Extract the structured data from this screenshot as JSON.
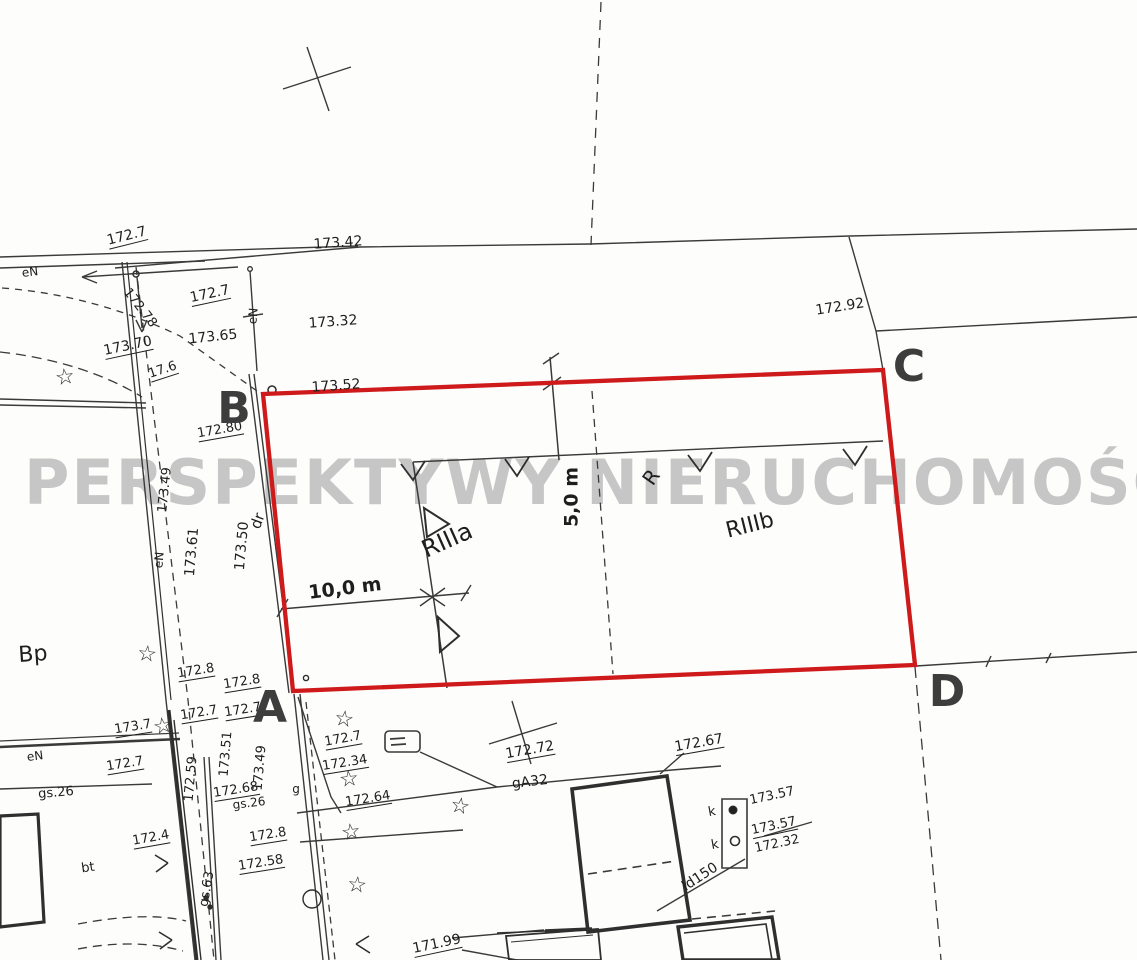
{
  "map": {
    "type": "cadastral-survey-map",
    "watermark": "PERSPEKTYWY NIERUCHOMOŚCI",
    "colors": {
      "plot_outline": "#ce1a1a",
      "line_ink": "#3a3a3a",
      "building_ink": "#2f2f2f",
      "watermark_gray": "#a6a6a6",
      "label_ink": "#1e1e1e"
    },
    "plot_corners": [
      {
        "id": "A",
        "x": 270,
        "y": 708
      },
      {
        "id": "B",
        "x": 234,
        "y": 409
      },
      {
        "id": "C",
        "x": 909,
        "y": 367
      },
      {
        "id": "D",
        "x": 947,
        "y": 692
      }
    ],
    "symbols": {
      "star_glyph": "☆"
    },
    "stars": [
      {
        "x": 65,
        "y": 378,
        "r": -8
      },
      {
        "x": 147,
        "y": 655,
        "r": 6
      },
      {
        "x": 163,
        "y": 727,
        "r": -10
      },
      {
        "x": 344,
        "y": 720,
        "r": 8
      },
      {
        "x": 349,
        "y": 780,
        "r": -6
      },
      {
        "x": 460,
        "y": 807,
        "r": 10
      },
      {
        "x": 351,
        "y": 833,
        "r": -8
      },
      {
        "x": 357,
        "y": 886,
        "r": 6
      }
    ],
    "labels": [
      {
        "t": "172.7",
        "x": 127,
        "y": 237,
        "r": -14,
        "s": 14,
        "u": 1,
        "n": "elevation-label"
      },
      {
        "t": "173.42",
        "x": 338,
        "y": 243,
        "r": -4,
        "s": 14,
        "n": "elevation-label"
      },
      {
        "t": "eN",
        "x": 30,
        "y": 272,
        "r": -6,
        "s": 12,
        "n": "utility-label"
      },
      {
        "t": "172.78",
        "x": 140,
        "y": 308,
        "r": 52,
        "s": 13,
        "n": "elevation-label"
      },
      {
        "t": "172.7",
        "x": 210,
        "y": 295,
        "r": -12,
        "s": 14,
        "u": 1,
        "n": "elevation-label"
      },
      {
        "t": "173.65",
        "x": 213,
        "y": 337,
        "r": -6,
        "s": 14,
        "n": "elevation-label"
      },
      {
        "t": "173.32",
        "x": 333,
        "y": 322,
        "r": -4,
        "s": 14,
        "n": "elevation-label"
      },
      {
        "t": "172.92",
        "x": 840,
        "y": 307,
        "r": -9,
        "s": 14,
        "n": "elevation-label"
      },
      {
        "t": "173.70",
        "x": 128,
        "y": 347,
        "r": -12,
        "s": 14,
        "u": 1,
        "n": "elevation-label"
      },
      {
        "t": "17.6",
        "x": 163,
        "y": 371,
        "r": -18,
        "s": 13,
        "u": 1,
        "n": "elevation-label"
      },
      {
        "t": "173.52",
        "x": 336,
        "y": 386,
        "r": -4,
        "s": 14,
        "n": "elevation-label"
      },
      {
        "t": "172.80",
        "x": 220,
        "y": 431,
        "r": -10,
        "s": 13,
        "u": 1,
        "n": "elevation-label"
      },
      {
        "t": "eN",
        "x": 253,
        "y": 316,
        "r": -85,
        "s": 12,
        "n": "utility-label"
      },
      {
        "t": "173.49",
        "x": 165,
        "y": 490,
        "r": -84,
        "s": 13,
        "n": "elevation-label"
      },
      {
        "t": "173.61",
        "x": 192,
        "y": 552,
        "r": -85,
        "s": 14,
        "n": "elevation-label"
      },
      {
        "t": "173.50",
        "x": 242,
        "y": 546,
        "r": -85,
        "s": 14,
        "n": "elevation-label"
      },
      {
        "t": "dr",
        "x": 258,
        "y": 521,
        "r": -70,
        "s": 15,
        "n": "landuse-label"
      },
      {
        "t": "eN",
        "x": 159,
        "y": 560,
        "r": -85,
        "s": 12,
        "n": "utility-label"
      },
      {
        "t": "Bp",
        "x": 33,
        "y": 655,
        "r": -4,
        "s": 22,
        "n": "landuse-label"
      },
      {
        "t": "RIIIa",
        "x": 447,
        "y": 540,
        "r": -24,
        "s": 24,
        "n": "landuse-label"
      },
      {
        "t": "RIIIb",
        "x": 750,
        "y": 526,
        "r": -14,
        "s": 22,
        "n": "landuse-label"
      },
      {
        "t": "R",
        "x": 651,
        "y": 477,
        "r": -55,
        "s": 20,
        "n": "landuse-label"
      },
      {
        "t": "10,0 m",
        "x": 345,
        "y": 589,
        "r": -7,
        "s": 19,
        "b": 1,
        "n": "dimension-label"
      },
      {
        "t": "5,0 m",
        "x": 572,
        "y": 497,
        "r": -90,
        "s": 19,
        "b": 1,
        "n": "dimension-label"
      },
      {
        "t": "172.8",
        "x": 196,
        "y": 672,
        "r": -9,
        "s": 13,
        "u": 1,
        "n": "elevation-label"
      },
      {
        "t": "172.8",
        "x": 242,
        "y": 683,
        "r": -9,
        "s": 13,
        "u": 1,
        "n": "elevation-label"
      },
      {
        "t": "173.7",
        "x": 133,
        "y": 728,
        "r": -9,
        "s": 13,
        "u": 1,
        "n": "elevation-label"
      },
      {
        "t": "172.7",
        "x": 199,
        "y": 714,
        "r": -9,
        "s": 13,
        "u": 1,
        "n": "elevation-label"
      },
      {
        "t": "172.7",
        "x": 243,
        "y": 711,
        "r": -9,
        "s": 13,
        "u": 1,
        "n": "elevation-label"
      },
      {
        "t": "172.7",
        "x": 125,
        "y": 765,
        "r": -9,
        "s": 13,
        "u": 1,
        "n": "elevation-label"
      },
      {
        "t": "eN",
        "x": 35,
        "y": 756,
        "r": -7,
        "s": 12,
        "n": "utility-label"
      },
      {
        "t": "gs.26",
        "x": 56,
        "y": 793,
        "r": -5,
        "s": 13,
        "n": "utility-label"
      },
      {
        "t": "172.7",
        "x": 343,
        "y": 740,
        "r": -10,
        "s": 13,
        "u": 1,
        "n": "elevation-label"
      },
      {
        "t": "172.34",
        "x": 345,
        "y": 764,
        "r": -9,
        "s": 13,
        "u": 1,
        "n": "elevation-label"
      },
      {
        "t": "172.64",
        "x": 368,
        "y": 800,
        "r": -9,
        "s": 13,
        "u": 1,
        "n": "elevation-label"
      },
      {
        "t": "172.68",
        "x": 236,
        "y": 791,
        "r": -9,
        "s": 13,
        "u": 1,
        "n": "elevation-label"
      },
      {
        "t": "gs.26",
        "x": 249,
        "y": 803,
        "r": -7,
        "s": 12,
        "n": "utility-label"
      },
      {
        "t": "173.51",
        "x": 226,
        "y": 754,
        "r": -85,
        "s": 13,
        "n": "elevation-label"
      },
      {
        "t": "172.59",
        "x": 191,
        "y": 779,
        "r": -85,
        "s": 13,
        "n": "elevation-label"
      },
      {
        "t": "173.49",
        "x": 260,
        "y": 768,
        "r": -85,
        "s": 13,
        "n": "elevation-label"
      },
      {
        "t": "g",
        "x": 296,
        "y": 789,
        "r": 0,
        "s": 12,
        "n": "utility-label"
      },
      {
        "t": "172.72",
        "x": 530,
        "y": 751,
        "r": -10,
        "s": 14,
        "u": 1,
        "n": "elevation-label"
      },
      {
        "t": "gA32",
        "x": 530,
        "y": 782,
        "r": -7,
        "s": 14,
        "n": "utility-label"
      },
      {
        "t": "172.67",
        "x": 699,
        "y": 744,
        "r": -10,
        "s": 14,
        "u": 1,
        "n": "elevation-label"
      },
      {
        "t": "bt",
        "x": 88,
        "y": 868,
        "r": -8,
        "s": 13,
        "n": "landuse-label"
      },
      {
        "t": "172.4",
        "x": 151,
        "y": 839,
        "r": -10,
        "s": 13,
        "u": 1,
        "n": "elevation-label"
      },
      {
        "t": "172.8",
        "x": 268,
        "y": 836,
        "r": -9,
        "s": 13,
        "u": 1,
        "n": "elevation-label"
      },
      {
        "t": "172.58",
        "x": 261,
        "y": 864,
        "r": -9,
        "s": 13,
        "u": 1,
        "n": "elevation-label"
      },
      {
        "t": "gs.63",
        "x": 207,
        "y": 889,
        "r": -80,
        "s": 13,
        "n": "utility-label"
      },
      {
        "t": "171.99",
        "x": 437,
        "y": 945,
        "r": -12,
        "s": 14,
        "u": 1,
        "n": "elevation-label"
      },
      {
        "t": "k",
        "x": 712,
        "y": 812,
        "r": -10,
        "s": 13,
        "n": "utility-label"
      },
      {
        "t": "k",
        "x": 715,
        "y": 845,
        "r": -10,
        "s": 13,
        "n": "utility-label"
      },
      {
        "t": "173.57",
        "x": 772,
        "y": 796,
        "r": -12,
        "s": 13,
        "n": "elevation-label"
      },
      {
        "t": "173.57",
        "x": 774,
        "y": 827,
        "r": -12,
        "s": 13,
        "u": 1,
        "n": "elevation-label"
      },
      {
        "t": "172.32",
        "x": 777,
        "y": 844,
        "r": -12,
        "s": 13,
        "n": "elevation-label"
      },
      {
        "t": "ld150",
        "x": 700,
        "y": 877,
        "r": -33,
        "s": 14,
        "n": "utility-label"
      }
    ]
  }
}
